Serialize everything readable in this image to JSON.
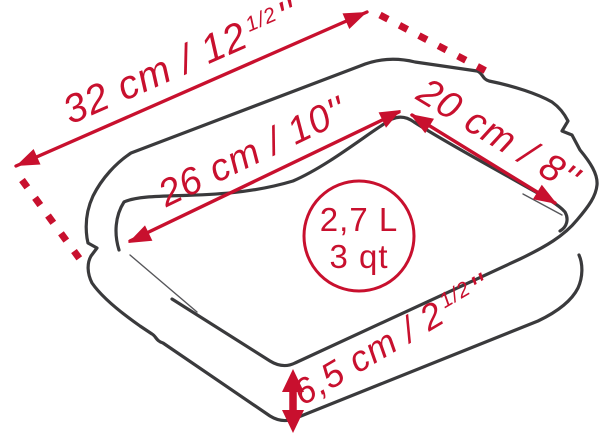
{
  "diagram": {
    "description": "Rectangular baking dish dimension diagram",
    "background_color": "#ffffff",
    "outline_color": "#3a3a3c",
    "dimension_color": "#c8102e",
    "dimensions": {
      "overall_length": {
        "main": "32 cm / 12",
        "fraction": "1/2",
        "unit": "''"
      },
      "inner_length": {
        "main": "26 cm / 10",
        "unit": "''"
      },
      "inner_width": {
        "main": "20 cm / 8",
        "unit": "''"
      },
      "height": {
        "main": "6,5 cm / 2",
        "fraction": "1/2",
        "unit": "''"
      }
    },
    "capacity": {
      "liters": "2,7 L",
      "quarts": "3 qt"
    }
  }
}
